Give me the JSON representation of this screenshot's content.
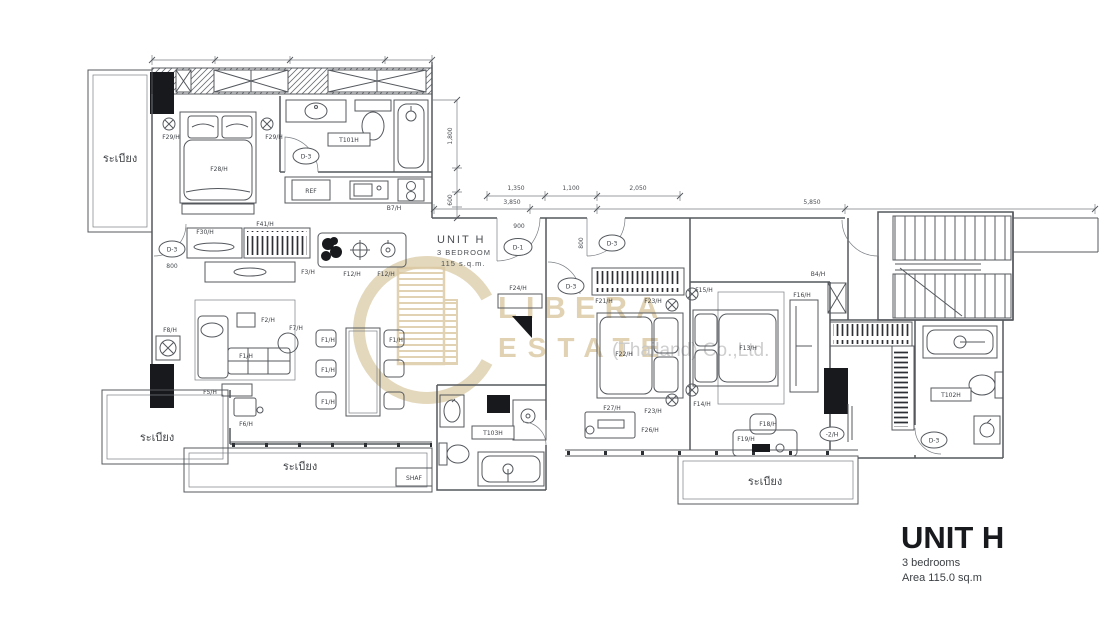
{
  "colors": {
    "background": "#ffffff",
    "line_ink": "#54585d",
    "solid_column": "#17191c",
    "watermark_beige": "#d9c7a0",
    "watermark_gray": "#c9c9c9"
  },
  "title_block": {
    "title": "UNIT H",
    "bedrooms": "3 bedrooms",
    "area": "Area 115.0 sq.m"
  },
  "unit_label": {
    "name": "UNIT H",
    "type": "3 BEDROOM",
    "area": "115  s.q.m."
  },
  "watermark": {
    "brand_top": "LIBERA",
    "brand_bottom": "ESTATE",
    "company": "(Thailand) Co.,Ltd."
  },
  "rooms": {
    "balcony": "ระเบียง",
    "shaft": "SHAF"
  },
  "doors": {
    "d1": "D-1",
    "d3": "D-3",
    "w2": "-2/H"
  },
  "dims": {
    "a1350": "1,350",
    "a1100": "1,100",
    "a2050": "2,050",
    "a3850": "3,850",
    "a5850": "5,850",
    "v1800": "1,800",
    "v600": "600",
    "w900": "900",
    "w800": "800"
  },
  "fixtures": {
    "t101": "T101H",
    "t102": "T102H",
    "t103": "T103H"
  },
  "furniture": {
    "f1": "F1/H",
    "f2": "F2/H",
    "f3": "F3/H",
    "f5": "F5/H",
    "f6": "F6/H",
    "f7": "F7/H",
    "f8": "F8/H",
    "f12": "F12/H",
    "f13": "F13/H",
    "f14": "F14/H",
    "f15": "F15/H",
    "f16": "F16/H",
    "f18": "F18/H",
    "f19": "F19/H",
    "f21": "F21/H",
    "f22": "F22/H",
    "f23": "F23/H",
    "f24": "F24/H",
    "f26": "F26/H",
    "f27": "F27/H",
    "f28": "F28/H",
    "f29": "F29/H",
    "f30": "F30/H",
    "f41": "F41/H",
    "ref": "REF",
    "b7": "B7/H",
    "b4": "B4/H"
  }
}
